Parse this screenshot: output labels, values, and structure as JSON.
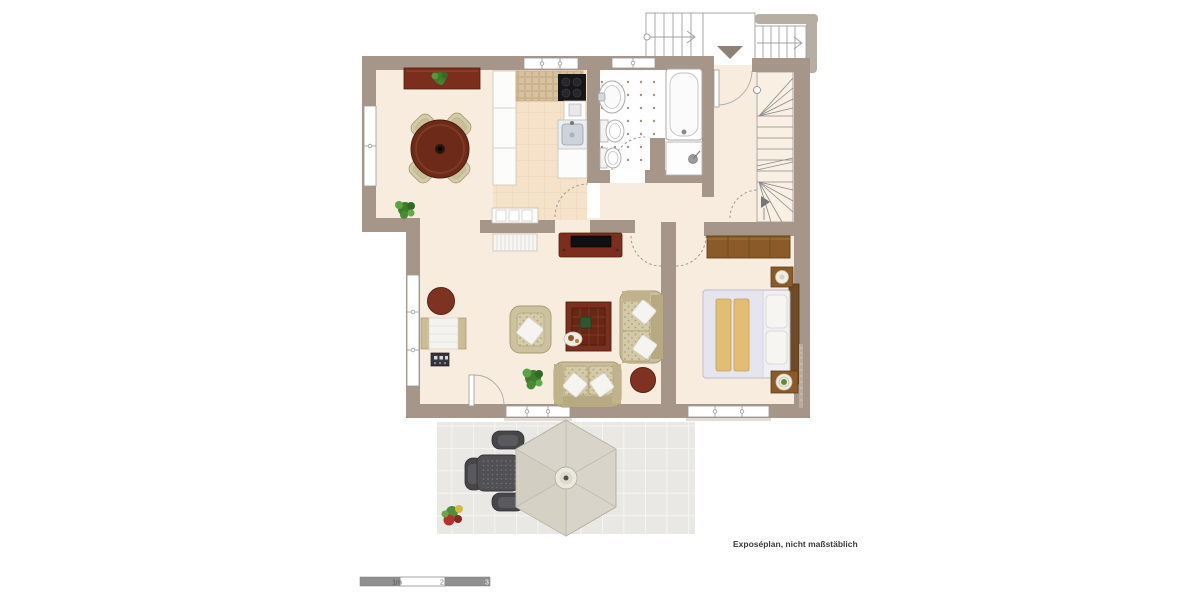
{
  "page": {
    "type": "floor-plan",
    "background": "#ffffff"
  },
  "disclaimer": "Exposéplan, nicht maßstäblich",
  "scale_bar": {
    "labels": [
      "1m",
      "2",
      "3"
    ]
  },
  "colors": {
    "wall": "#a59689",
    "floor": "#f8ecdf",
    "kitchen_floor": "#f5e2c9",
    "bathroom_floor": "#ffffff",
    "terrace_tiles": "#e9e8e4",
    "red_wood_furniture": "#7b2e1d",
    "brown_wood_furniture": "#8a5a28",
    "upholstery_beige": "#cdc2a0",
    "bed_linen": "#e6e5ef",
    "blanket_tan": "#e2bd74",
    "plant_green": "#3f7d2c",
    "parasol": "#d8d4c9",
    "stair_outline": "#8a8a8a"
  },
  "rooms": [
    {
      "id": "dining-area",
      "furniture": [
        "sideboard-with-plant",
        "round-dining-table",
        "dining-chairs-x4",
        "potted-plant"
      ]
    },
    {
      "id": "kitchen",
      "furniture": [
        "counter-run",
        "tiled-worktop",
        "stove",
        "sink",
        "base-cabinet"
      ]
    },
    {
      "id": "bathroom",
      "furniture": [
        "washbasin",
        "toilet",
        "bidet",
        "bathtub",
        "shower"
      ]
    },
    {
      "id": "hallway",
      "furniture": [
        "entrance-door"
      ]
    },
    {
      "id": "staircase",
      "furniture": [
        "winder-staircase",
        "direction-arrow"
      ]
    },
    {
      "id": "living-room",
      "furniture": [
        "tv-lowboard",
        "radiator",
        "white-sideboard",
        "daybed",
        "stereo",
        "pouf",
        "armchair",
        "coffee-table",
        "loveseat-x2",
        "round-side-table-x2",
        "plant"
      ]
    },
    {
      "id": "bedroom",
      "furniture": [
        "wardrobe",
        "double-bed",
        "nightstand-x2"
      ]
    },
    {
      "id": "terrace",
      "furniture": [
        "parasol",
        "bistro-table",
        "terrace-chairs-x3",
        "flower-pot"
      ]
    },
    {
      "id": "exterior-stairs",
      "furniture": [
        "stair-flight-left",
        "entry-landing",
        "stair-flight-right",
        "entry-direction-triangle"
      ]
    }
  ]
}
